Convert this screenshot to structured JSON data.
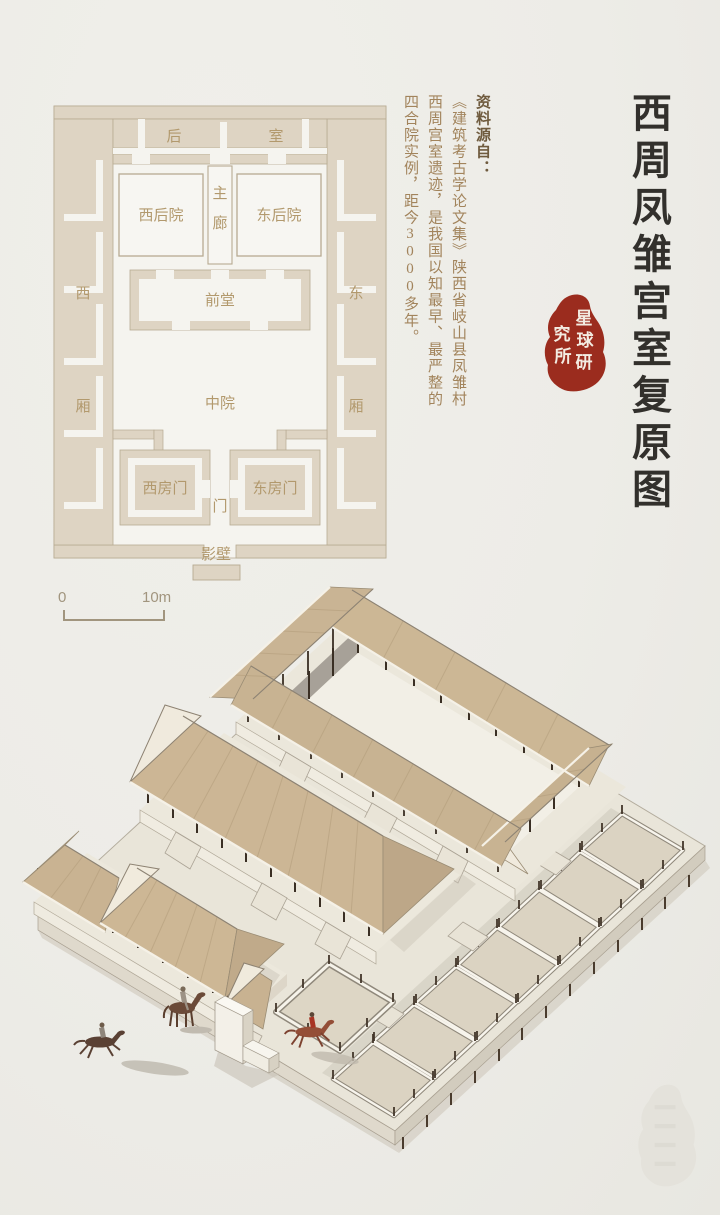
{
  "title": {
    "text": "西周凤雏宫室复原图"
  },
  "source_note": {
    "heading": "资料源自：",
    "line1": "《建筑考古学论文集》陕西省岐山县凤雏村",
    "line2": "西周宫室遗迹，是我国以知最早、最严整的",
    "line3": "四合院实例，距今3000多年。"
  },
  "seal": {
    "name": "星球研究所",
    "color": "#9b2c1e",
    "right_chars": [
      "星",
      "球",
      "研"
    ],
    "left_chars": [
      "究",
      "所"
    ]
  },
  "floor_plan": {
    "labels": {
      "rear_hall_left": "后",
      "rear_hall_right": "室",
      "west_rear_court": "西后院",
      "east_rear_court": "东后院",
      "corridor_top": "主",
      "corridor_bottom": "廊",
      "front_hall": "前堂",
      "central_court": "中院",
      "west": "西",
      "east": "东",
      "wing_west": "厢",
      "wing_east": "厢",
      "west_door_room": "西房门",
      "east_door_room": "东房门",
      "gate": "门",
      "screen_wall": "影壁"
    },
    "colors": {
      "wall": "#ded4c3",
      "outline": "#b7aa92",
      "label": "#b2996d"
    }
  },
  "scale_bar": {
    "start": "0",
    "end": "10m"
  },
  "axonometric": {
    "watermark_text": "星球研究所",
    "colors": {
      "thatch": "#cbb493",
      "platform": "#e9e5d9",
      "post": "#3f3226",
      "shadow_wall": "#98928a",
      "horse_dark": "#5a4134",
      "horse_red": "#944e37",
      "rider_red": "#a83524"
    }
  }
}
